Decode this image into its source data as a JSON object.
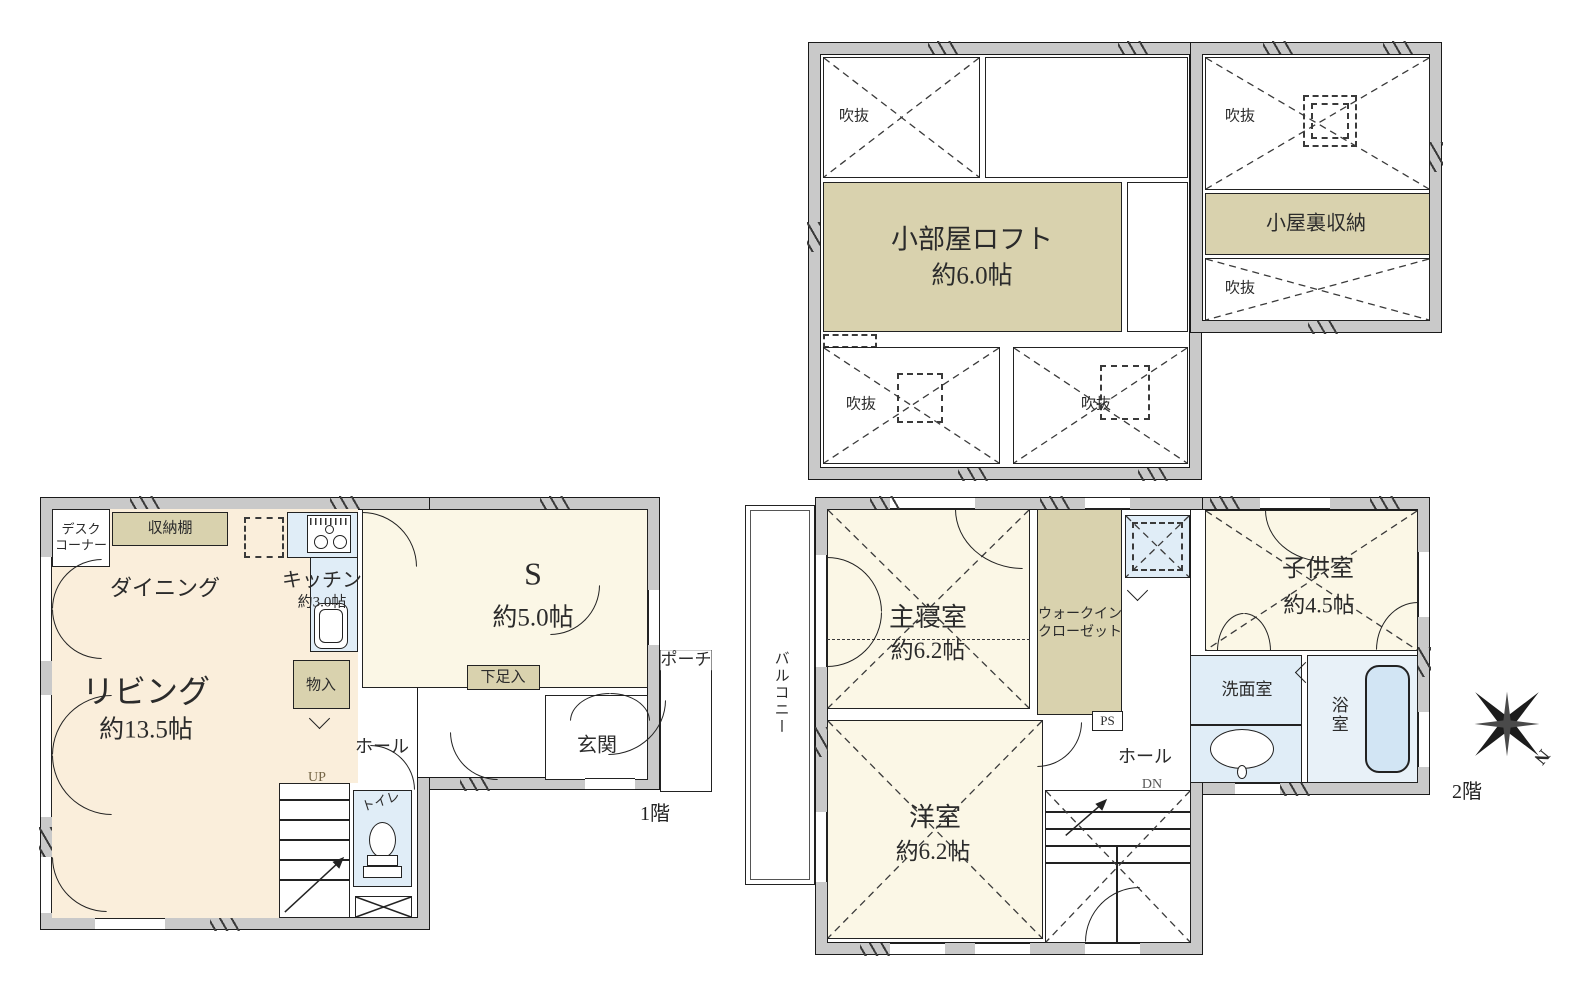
{
  "loft": {
    "void_label": "吹抜",
    "loft_room_name": "小部屋ロフト",
    "loft_room_size": "約6.0帖",
    "attic_storage": "小屋裏収納"
  },
  "f1": {
    "caption": "1階",
    "desk_corner_l1": "デスク",
    "desk_corner_l2": "コーナー",
    "shelf": "収納棚",
    "dining": "ダイニング",
    "kitchen_name": "キッチン",
    "kitchen_size": "約3.0帖",
    "s_room_name": "S",
    "s_room_size": "約5.0帖",
    "living_name": "リビング",
    "living_size": "約13.5帖",
    "storage": "物入",
    "shoe_box": "下足入",
    "hall": "ホール",
    "entrance": "玄関",
    "porch": "ポーチ",
    "toilet": "トイレ",
    "up": "UP"
  },
  "f2": {
    "caption": "2階",
    "balcony": "バルコニー",
    "master_name": "主寝室",
    "master_size": "約6.2帖",
    "wic_l1": "ウォークイン",
    "wic_l2": "クローゼット",
    "ps": "PS",
    "kids_name": "子供室",
    "kids_size": "約4.5帖",
    "washroom": "洗面室",
    "bathroom": "浴室",
    "hall": "ホール",
    "western_name": "洋室",
    "western_size": "約6.2帖",
    "dn": "DN",
    "compass_n": "N"
  },
  "colors": {
    "room_cream": "#faeedb",
    "room_pale": "#fbf7e6",
    "storage_beige": "#d9d2ae",
    "water_blue": "#e0edf7",
    "wall_gray": "#c9c9c9"
  }
}
